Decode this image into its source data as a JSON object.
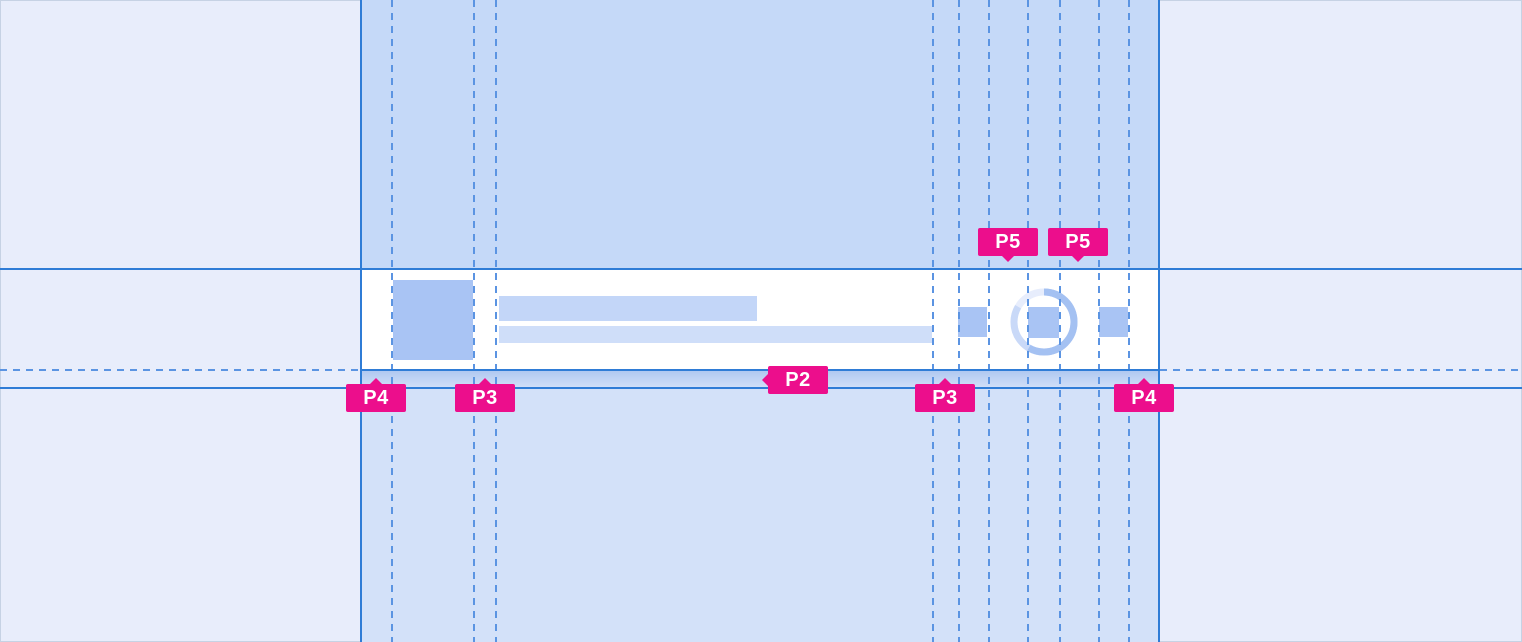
{
  "colors": {
    "canvas_bg": "#e8edfb",
    "column_bg": "#c5d9f8",
    "column_bg_lower": "#d3e1f9",
    "card_bg": "#ffffff",
    "placeholder_blue": "#a9c4f4",
    "line_placeholder_1": "#c3d6f8",
    "line_placeholder_2": "#cfdef9",
    "guide_solid": "#2f7cd6",
    "guide_dashed": "#5b94e2",
    "label_pink": "#ec0e8c",
    "label_text": "#ffffff",
    "shadow_top": "#aec7f0",
    "shadow_bottom": "#d2e0f8",
    "spinner_track": "#e7edfc",
    "spinner_arc_mid": "#c9d9f8",
    "spinner_arc": "#a4c1f2"
  },
  "labels": {
    "p5_first": "P5",
    "p5_second": "P5",
    "p2": "P2",
    "p4_left": "P4",
    "p3_left": "P3",
    "p3_right": "P3",
    "p4_right": "P4"
  },
  "component": {
    "avatar_icon": "avatar-placeholder",
    "title_line": "text-line-placeholder",
    "subtitle_line": "text-line-placeholder",
    "trailing_icon_1": "icon-placeholder",
    "trailing_icon_2": "icon-placeholder",
    "trailing_icon_3": "icon-placeholder",
    "spinner_icon": "loading-spinner"
  }
}
